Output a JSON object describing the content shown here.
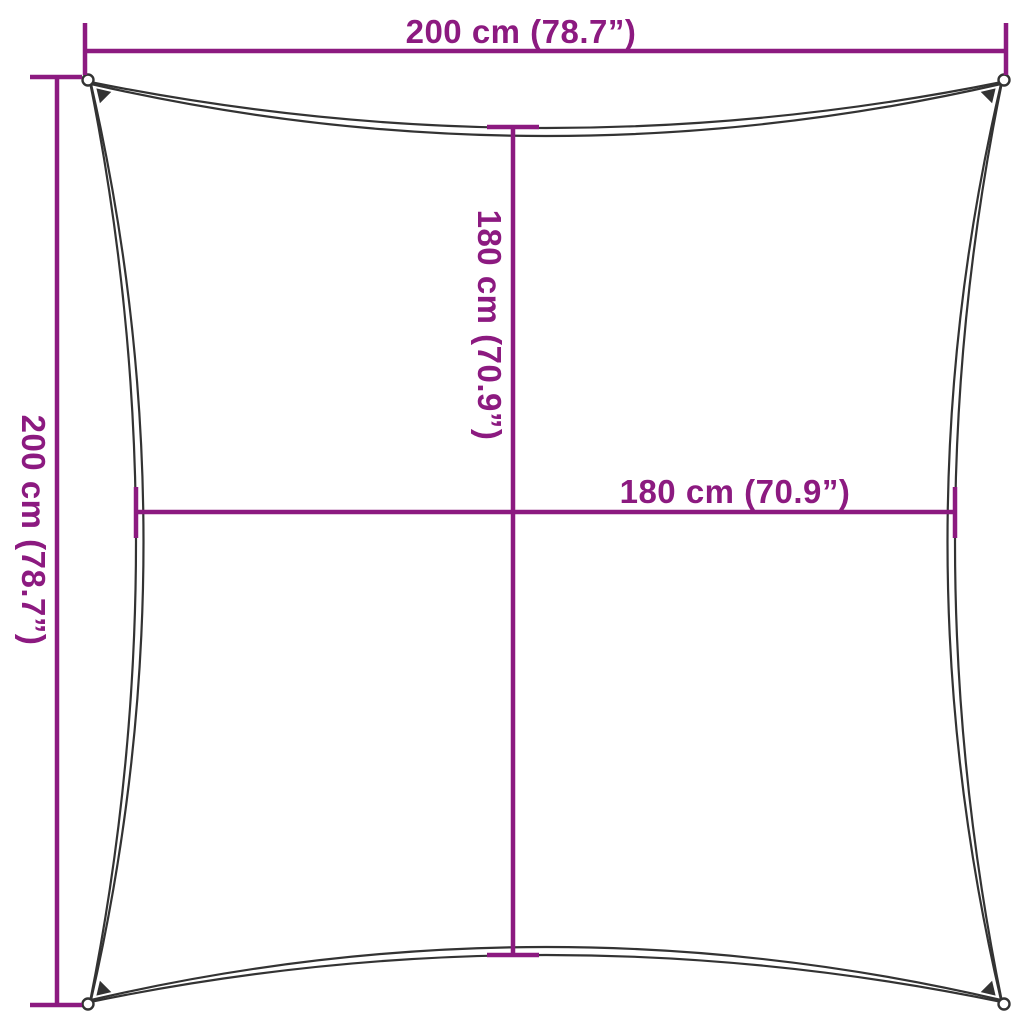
{
  "diagram": {
    "subject": "square-shade-sail-with-concave-edges",
    "corner_detail": "grommet-ring-with-reinforcement-patch"
  },
  "colors": {
    "dimension_accent": "#8C1A80",
    "sail_outline": "#333333",
    "background": "#FFFFFF"
  },
  "dimensions": {
    "top": {
      "label": "200 cm (78.7”)",
      "value_cm": 200,
      "value_in": 78.7,
      "orientation": "horizontal",
      "measures": "overall width corner to corner"
    },
    "left": {
      "label": "200 cm (78.7”)",
      "value_cm": 200,
      "value_in": 78.7,
      "orientation": "vertical",
      "measures": "overall height corner to corner"
    },
    "inner_vertical": {
      "label": "180 cm (70.9”)",
      "value_cm": 180,
      "value_in": 70.9,
      "orientation": "vertical",
      "measures": "edge midpoint to edge midpoint height"
    },
    "inner_horizontal": {
      "label": "180 cm (70.9”)",
      "value_cm": 180,
      "value_in": 70.9,
      "orientation": "horizontal",
      "measures": "edge midpoint to edge midpoint width"
    }
  }
}
